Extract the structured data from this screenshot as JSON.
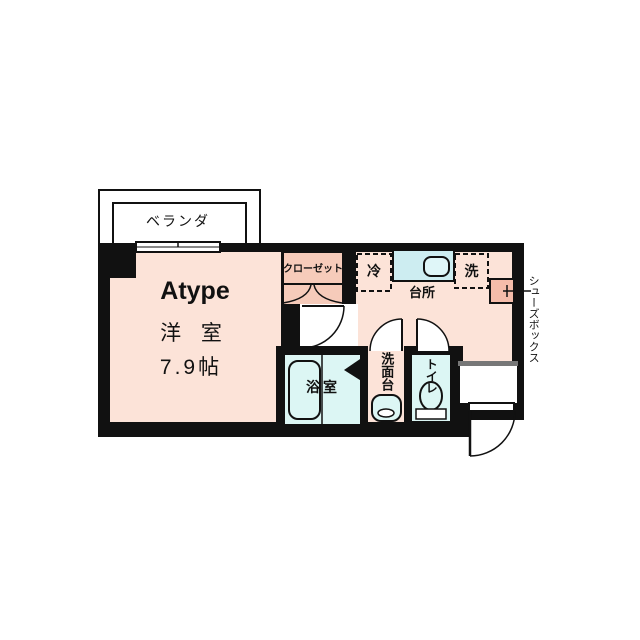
{
  "plan": {
    "unit_type": "Atype",
    "veranda": {
      "label": "ベランダ"
    },
    "main_room": {
      "name": "洋 室",
      "size": "7.9帖"
    },
    "closet": {
      "label": "クローゼット"
    },
    "refrigerator": {
      "label": "冷"
    },
    "kitchen": {
      "label": "台所"
    },
    "washing_machine": {
      "label": "洗"
    },
    "shoe_box": {
      "label": "シューズボックス"
    },
    "bathroom": {
      "label": "浴室"
    },
    "washstand": {
      "label": "洗面台"
    },
    "toilet": {
      "label": "トイレ"
    }
  },
  "colors": {
    "wall": "#111111",
    "floor_main": "#fce3d8",
    "floor_closet": "#f6cbba",
    "floor_shoebox": "#f5bcaa",
    "counter_cyan": "#cdedf1",
    "sink_cyan": "#dff6f8",
    "wet_cyan": "#dcf6f4",
    "step_gray": "#777777",
    "white": "#ffffff"
  }
}
